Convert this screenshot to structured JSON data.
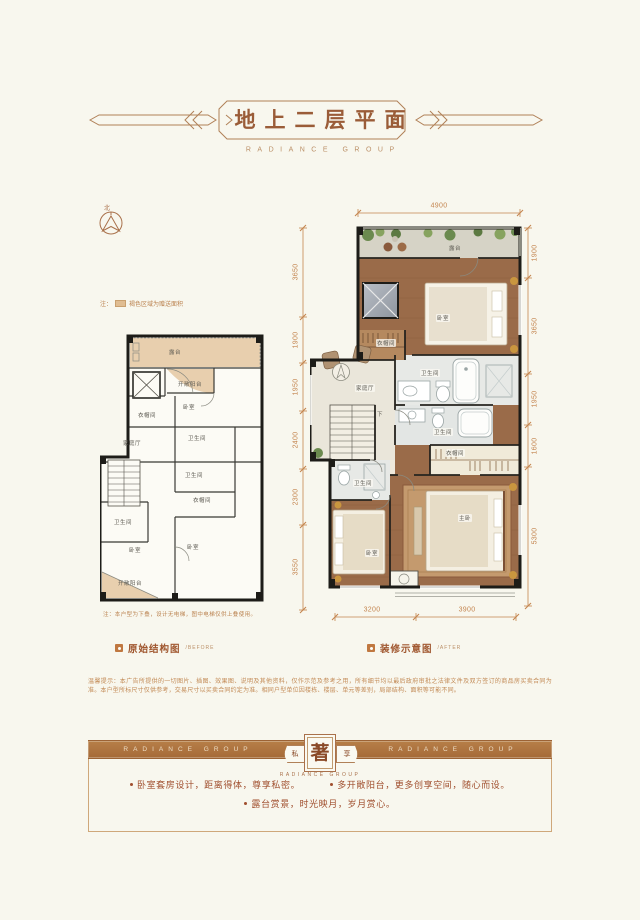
{
  "header": {
    "title": "地上二层平面",
    "subtitle": "RADIANCE GROUP"
  },
  "compass": {
    "north": "北"
  },
  "legend_note": {
    "prefix": "注：",
    "text": "褐色区域为赠送面积"
  },
  "before_plan": {
    "caption": "原始结构图",
    "caption_en": "/BEFORE",
    "note": "注：本户型为下叠，设计无电梯，图中电梯仅供上叠使用。",
    "rooms": {
      "terrace": "露台",
      "open_balcony_top": "开敞阳台",
      "closet_top": "衣帽间",
      "bedroom_top": "卧室",
      "bath_top": "卫生间",
      "family_hall": "家庭厅",
      "bath_mid": "卫生间",
      "closet_mid": "衣帽间",
      "bath_left": "卫生间",
      "bedroom_left": "卧室",
      "bedroom_right": "卧室",
      "open_balcony_bottom": "开敞阳台"
    }
  },
  "after_plan": {
    "caption": "装修示意图",
    "caption_en": "/AFTER",
    "rooms": {
      "terrace": "露台",
      "bedroom_top": "卧室",
      "closet_top": "衣帽间",
      "family_hall": "家庭厅",
      "bath_upper": "卫生间",
      "bath_mid": "卫生间",
      "stairs_down": "下",
      "closet_corridor": "衣帽间",
      "bath_small": "卫生间",
      "master_bedroom": "主卧",
      "bedroom_bottom": "卧室"
    },
    "dims": {
      "top": "4900",
      "left": [
        "3650",
        "1900",
        "1950",
        "2400",
        "2300",
        "3550"
      ],
      "right": [
        "1900",
        "3650",
        "1950",
        "1600",
        "5300"
      ],
      "bottom": [
        "3200",
        "3900"
      ]
    }
  },
  "disclaimer": "温馨提示：本广告所提供的一切图片、插图、效果图、说明及其他资料，仅作示范及参考之用，所有细节均以最后政府审批之法律文件及双方签订的商品房买卖合同为准。本户型所标尺寸仅供参考，交易尺寸以买卖合同约定为准。相同户型单位因楼栋、楼层、单元等差别，局部结构、面积等可能不同。",
  "banner": {
    "left_text": "RADIANCE GROUP",
    "right_text": "RADIANCE GROUP",
    "seal_left": "私",
    "seal_center": "著",
    "seal_right": "享",
    "seal_sub": "RADIANCE GROUP"
  },
  "features": [
    "卧室套房设计，距离得体，尊享私密。",
    "多开敞阳台，更多创享空间，随心而设。",
    "露台赏景，时光映月，岁月赏心。"
  ],
  "colors": {
    "accent": "#a9714b",
    "band": "#b0763f",
    "dim_text": "#c4854f",
    "gift_area": "#e8cfae",
    "feature_text": "#a04f2e"
  }
}
